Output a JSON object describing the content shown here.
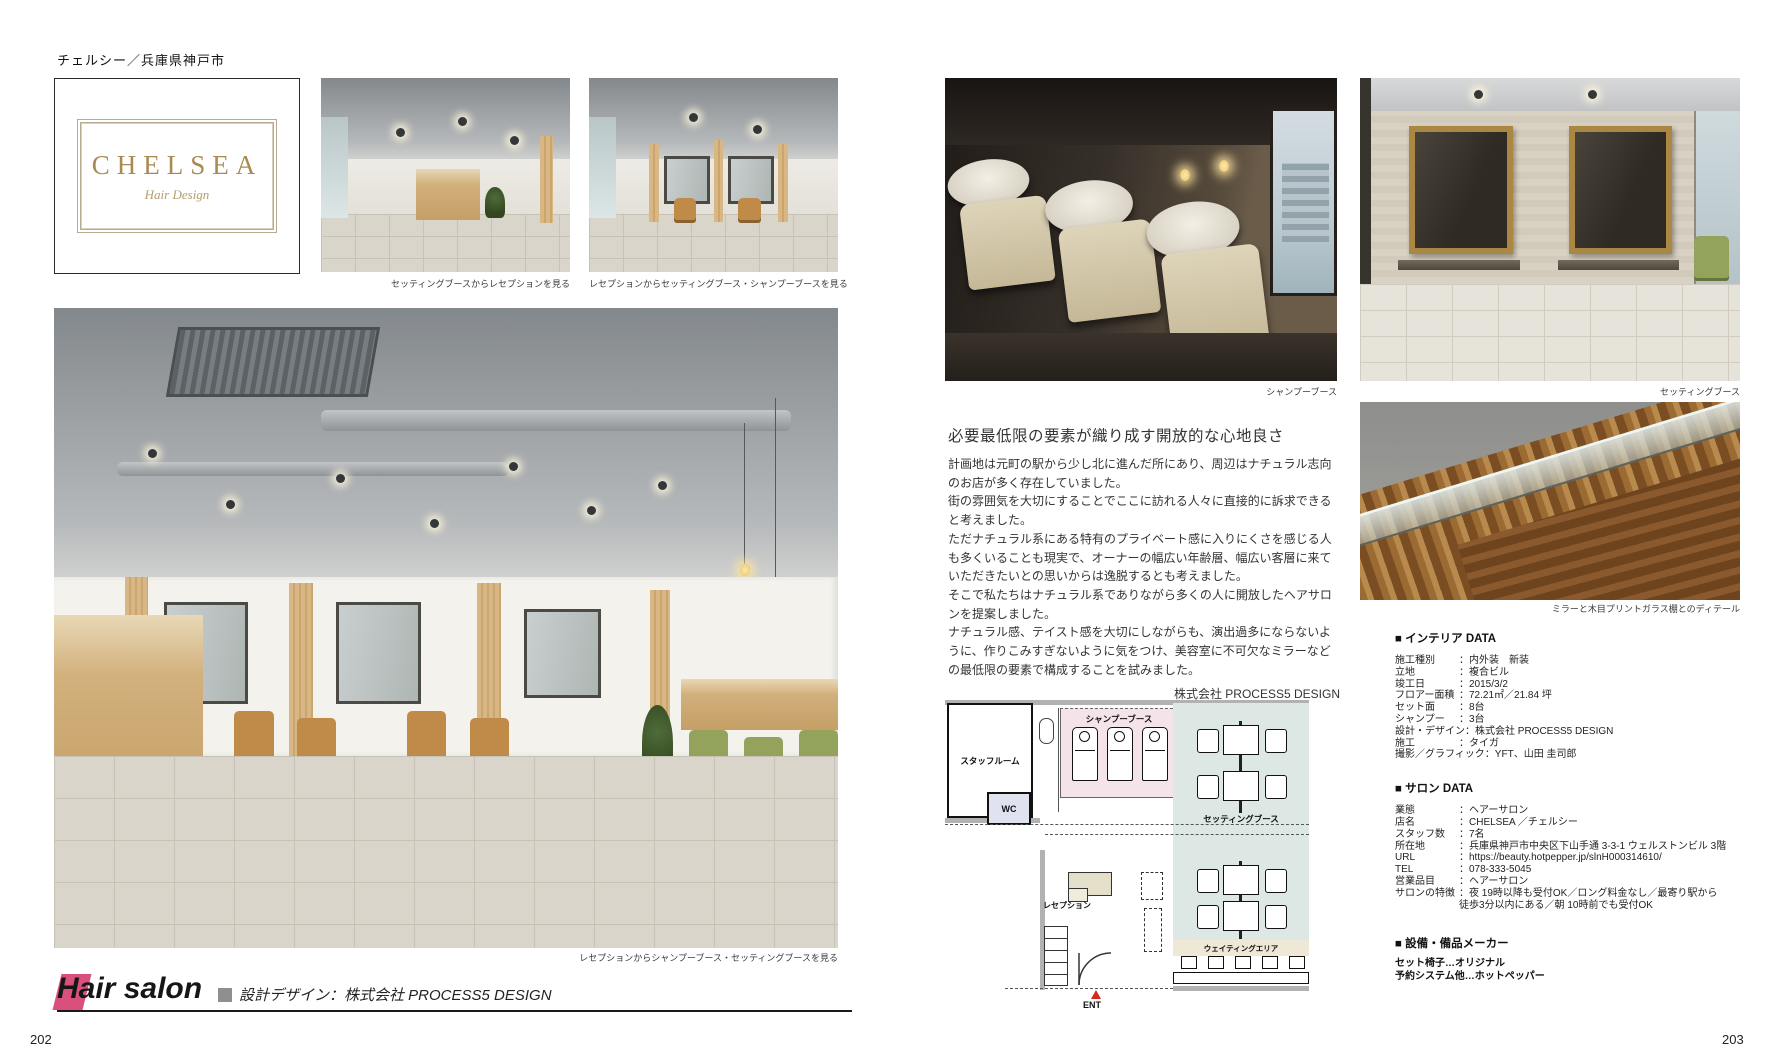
{
  "left_page": {
    "kicker": "チェルシー／兵庫県神戸市",
    "logo": {
      "title": "CHELSEA",
      "subtitle": "Hair Design"
    },
    "captions": {
      "photo_top_center": "セッティングブースからレセプションを見る",
      "photo_top_right": "レセプションからセッティングブース・シャンプーブースを見る",
      "photo_main": "レセプションからシャンプーブース・セッティングブースを見る"
    },
    "footer": {
      "category": "Hair salon",
      "credit": "設計デザイン：株式会社 PROCESS5 DESIGN"
    },
    "page_number": "202"
  },
  "right_page": {
    "captions": {
      "photo_shampoo": "シャンプーブース",
      "photo_setting": "セッティングブース",
      "photo_detail": "ミラーと木目プリントガラス棚とのディテール"
    },
    "article": {
      "heading": "必要最低限の要素が織り成す開放的な心地良さ",
      "paragraphs": [
        "計画地は元町の駅から少し北に進んだ所にあり、周辺はナチュラル志向のお店が多く存在していました。",
        "街の雰囲気を大切にすることでここに訪れる人々に直接的に訴求できると考えました。",
        "ただナチュラル系にある特有のプライベート感に入りにくさを感じる人も多くいることも現実で、オーナーの幅広い年齢層、幅広い客層に来ていただきたいとの思いからは逸脱するとも考えました。",
        "そこで私たちはナチュラル系でありながら多くの人に開放したヘアサロンを提案しました。",
        "ナチュラル感、テイスト感を大切にしながらも、演出過多にならないように、作りこみすぎないように気をつけ、美容室に不可欠なミラーなどの最低限の要素で構成することを試みました。"
      ],
      "credit": "株式会社 PROCESS5 DESIGN"
    },
    "floor_plan": {
      "staff_room": "スタッフルーム",
      "wc": "WC",
      "shampoo_booth": "シャンプーブース",
      "setting_booth": "セッティングブース",
      "reception": "レセプション",
      "waiting_area": "ウェイティングエリア",
      "entrance": "ENT"
    },
    "interior_data": {
      "heading": "■ インテリア DATA",
      "rows": [
        {
          "label": "施工種別",
          "value": "：内外装　新装"
        },
        {
          "label": "立地",
          "value": "：複合ビル"
        },
        {
          "label": "竣工日",
          "value": "：2015/3/2"
        },
        {
          "label": "フロアー面積",
          "value": "：72.21㎡／21.84 坪"
        },
        {
          "label": "セット面",
          "value": "：8台"
        },
        {
          "label": "シャンプー",
          "value": "：3台"
        },
        {
          "label": "設計・デザイン",
          "value": "：株式会社 PROCESS5 DESIGN"
        },
        {
          "label": "施工",
          "value": "：タイガ"
        },
        {
          "label": "撮影／グラフィック",
          "value": "：YFT、山田 圭司郎"
        }
      ]
    },
    "salon_data": {
      "heading": "■ サロン DATA",
      "rows": [
        {
          "label": "業態",
          "value": "：ヘアーサロン"
        },
        {
          "label": "店名",
          "value": "：CHELSEA ／チェルシー"
        },
        {
          "label": "スタッフ数",
          "value": "：7名"
        },
        {
          "label": "所在地",
          "value": "：兵庫県神戸市中央区下山手通 3-3-1 ウェルストンビル 3階"
        },
        {
          "label": "URL",
          "value": "：https://beauty.hotpepper.jp/slnH000314610/"
        },
        {
          "label": "TEL",
          "value": "：078-333-5045"
        },
        {
          "label": "営業品目",
          "value": "：ヘアーサロン"
        },
        {
          "label": "サロンの特徴",
          "value": "：夜 19時以降も受付OK／ロング料金なし／最寄り駅から\n徒歩3分以内にある／朝 10時前でも受付OK"
        }
      ]
    },
    "makers": {
      "heading": "■ 設備・備品メーカー",
      "lines": [
        "セット椅子…オリジナル",
        "予約システム他…ホットペッパー"
      ]
    },
    "page_number": "203"
  },
  "colors": {
    "accent_pink": "#d9507c",
    "logo_gold": "#a98a52",
    "plan_shampoo_pink": "#f4e3e8",
    "plan_setting_teal": "#dde8e5",
    "entrance_red": "#d42a1e"
  }
}
